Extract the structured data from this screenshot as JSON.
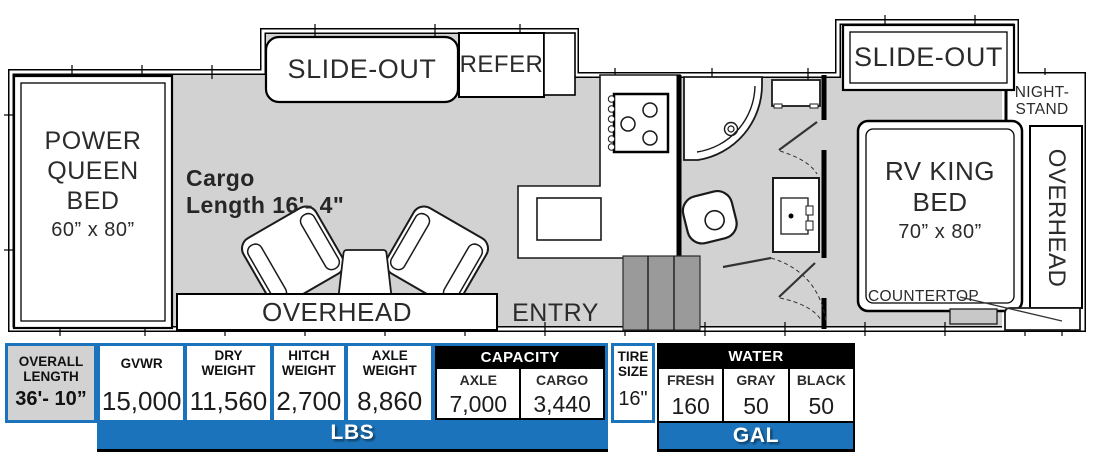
{
  "floorplan": {
    "front_bed": {
      "line1": "POWER",
      "line2": "QUEEN BED",
      "size": "60” x 80”"
    },
    "cargo_line1": "Cargo",
    "cargo_line2": "Length 16'- 4\"",
    "slide_out_left": "SLIDE-OUT",
    "refer": "REFER",
    "overhead_garage": "OVERHEAD",
    "entry": "ENTRY",
    "slide_out_right": "SLIDE-OUT",
    "nightstand_line1": "NIGHT-",
    "nightstand_line2": "STAND",
    "king_bed": {
      "line1": "RV KING",
      "line2": "BED",
      "size": "70” x 80”"
    },
    "countertop": "COUNTERTOP",
    "overhead_bedroom": "OVERHEAD"
  },
  "spec_table": {
    "overall_length": {
      "label_line1": "OVERALL",
      "label_line2": "LENGTH",
      "value": "36'- 10”"
    },
    "columns": [
      {
        "label": "GVWR",
        "value": "15,000"
      },
      {
        "label": "DRY WEIGHT",
        "value": "11,560"
      },
      {
        "label": "HITCH WEIGHT",
        "value": "2,700"
      },
      {
        "label": "AXLE WEIGHT",
        "value": "8,860"
      }
    ],
    "capacity": {
      "header": "CAPACITY",
      "cells": [
        {
          "label": "AXLE",
          "value": "7,000"
        },
        {
          "label": "CARGO",
          "value": "3,440"
        }
      ]
    },
    "tire_size": {
      "label_line1": "TIRE",
      "label_line2": "SIZE",
      "value": "16\""
    },
    "water": {
      "header": "WATER",
      "cells": [
        {
          "label": "FRESH",
          "value": "160"
        },
        {
          "label": "GRAY",
          "value": "50"
        },
        {
          "label": "BLACK",
          "value": "50"
        }
      ]
    },
    "unit_lbs": "LBS",
    "unit_gal": "GAL"
  },
  "colors": {
    "accent_blue": "#1b74bb",
    "header_black": "#000000",
    "cell_gray": "#d2d2d2",
    "floor_gray": "#d2d2d2",
    "steps_gray": "#9a9a9a"
  }
}
